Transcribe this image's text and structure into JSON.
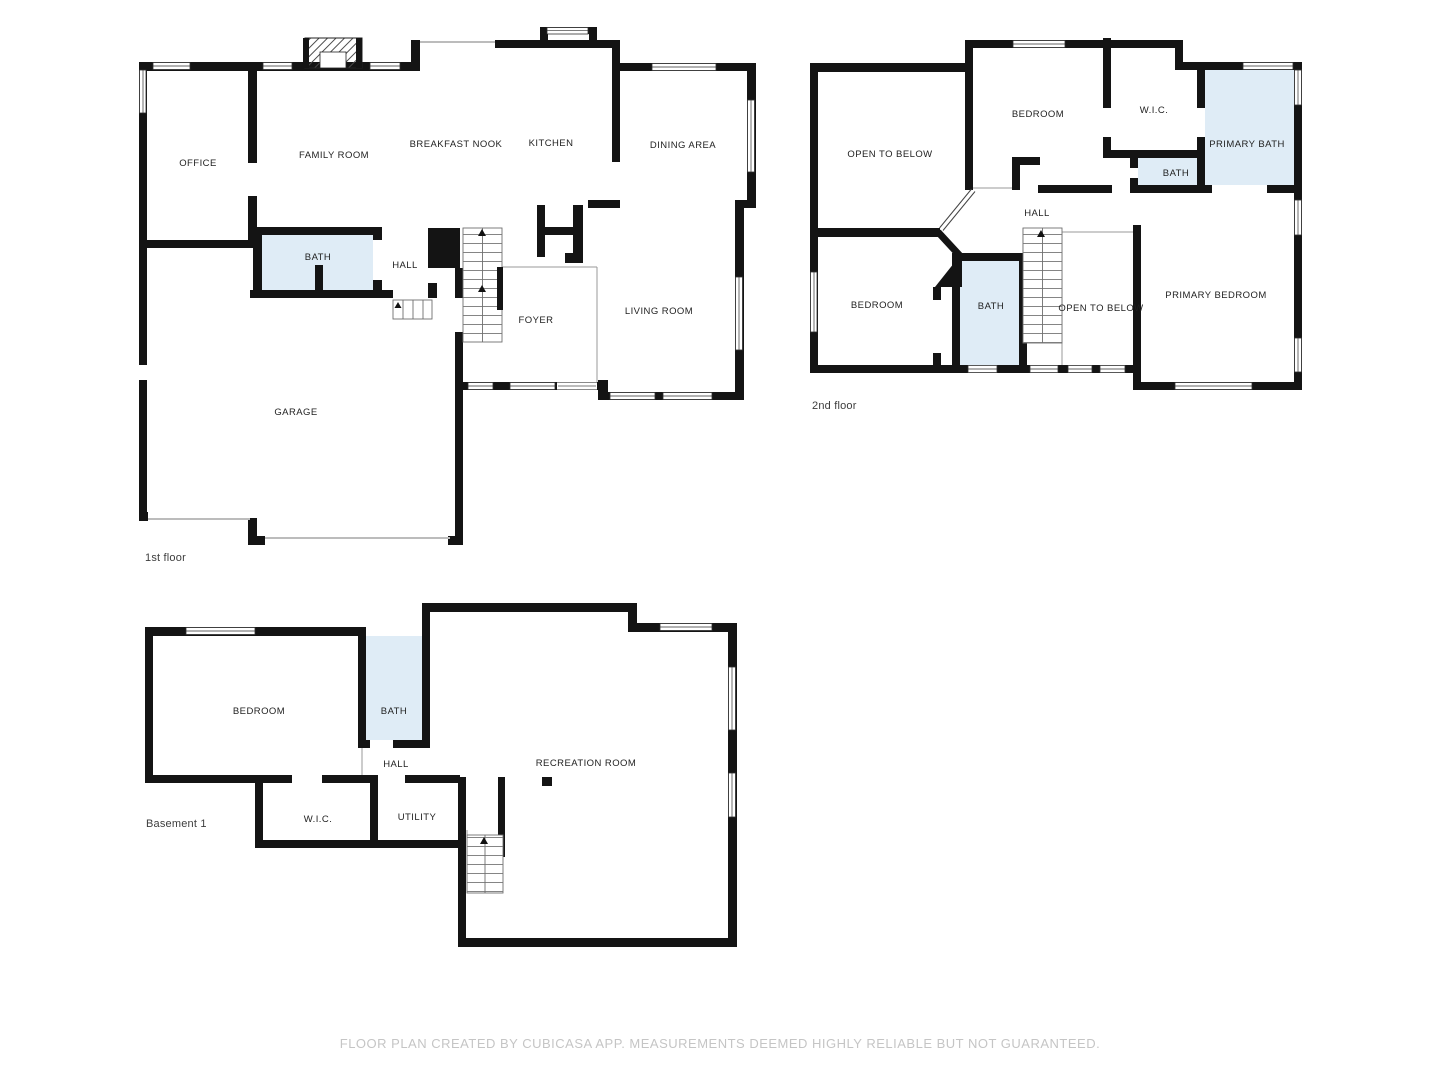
{
  "floor1": {
    "label": "1st floor",
    "rooms": {
      "office": "OFFICE",
      "family_room": "FAMILY ROOM",
      "breakfast_nook": "BREAKFAST NOOK",
      "kitchen": "KITCHEN",
      "dining_area": "DINING AREA",
      "bath": "BATH",
      "hall": "HALL",
      "foyer": "FOYER",
      "living_room": "LIVING ROOM",
      "garage": "GARAGE"
    }
  },
  "floor2": {
    "label": "2nd floor",
    "rooms": {
      "open_to_below_left": "OPEN TO BELOW",
      "bedroom_top": "BEDROOM",
      "wic": "W.I.C.",
      "primary_bath": "PRIMARY BATH",
      "bath_small": "BATH",
      "hall": "HALL",
      "bedroom_left": "BEDROOM",
      "bath": "BATH",
      "open_to_below_center": "OPEN TO BELOW",
      "primary_bedroom": "PRIMARY BEDROOM"
    }
  },
  "basement": {
    "label": "Basement 1",
    "rooms": {
      "bedroom": "BEDROOM",
      "bath": "BATH",
      "hall": "HALL",
      "recreation_room": "RECREATION ROOM",
      "wic": "W.I.C.",
      "utility": "UTILITY"
    }
  },
  "footer": "FLOOR PLAN CREATED BY CUBICASA APP. MEASUREMENTS DEEMED HIGHLY RELIABLE BUT NOT GUARANTEED.",
  "colors": {
    "wall": "#141414",
    "bath_fill": "#dfecf6",
    "label": "#1f1f1f",
    "floor_label": "#3d3d3d",
    "footer": "#c5c5c5"
  }
}
